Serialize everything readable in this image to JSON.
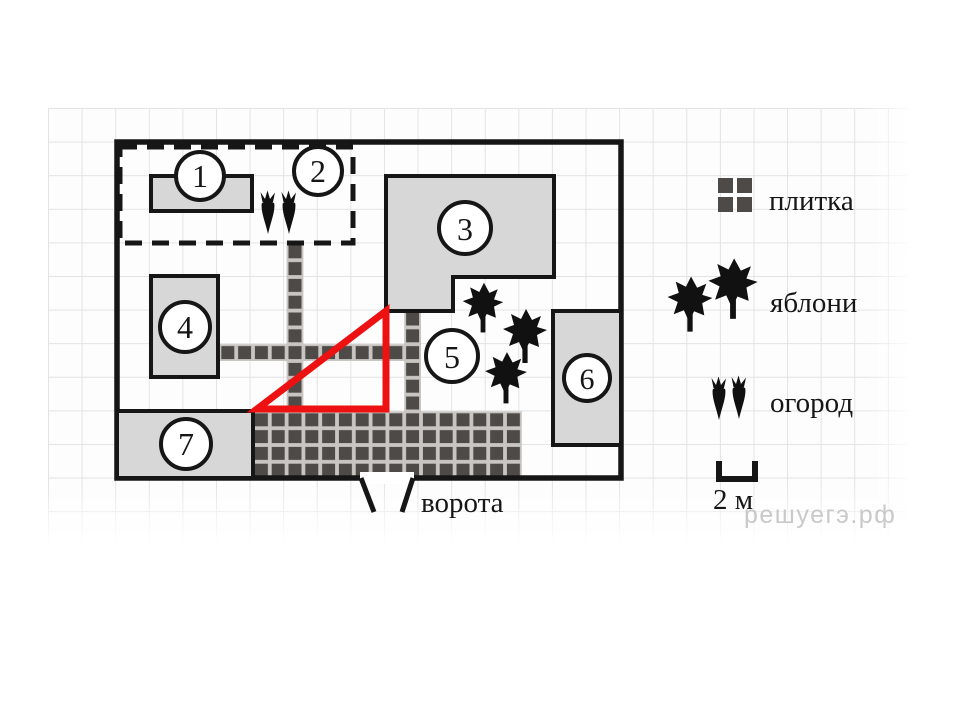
{
  "plan": {
    "buildings": [
      {
        "label": "1"
      },
      {
        "label": "2"
      },
      {
        "label": "3"
      },
      {
        "label": "4"
      },
      {
        "label": "5"
      },
      {
        "label": "6"
      },
      {
        "label": "7"
      }
    ],
    "gate_label": "ворота"
  },
  "legend": {
    "items": [
      {
        "icon": "tile-icon",
        "label": "плитка"
      },
      {
        "icon": "apple-trees-icon",
        "label": "яблони"
      },
      {
        "icon": "garden-icon",
        "label": "огород"
      }
    ],
    "scale_label": "2 м"
  },
  "watermark": "решуегэ.рф",
  "colors": {
    "outline": "#161616",
    "building_fill": "#d7d7d7",
    "tile_dark": "#4d4a47",
    "tile_gap": "#c9c6c2",
    "highlight_red": "#ee1111",
    "grid_line": "#e3e3e3",
    "watermark_gray": "#c9c9c9"
  }
}
